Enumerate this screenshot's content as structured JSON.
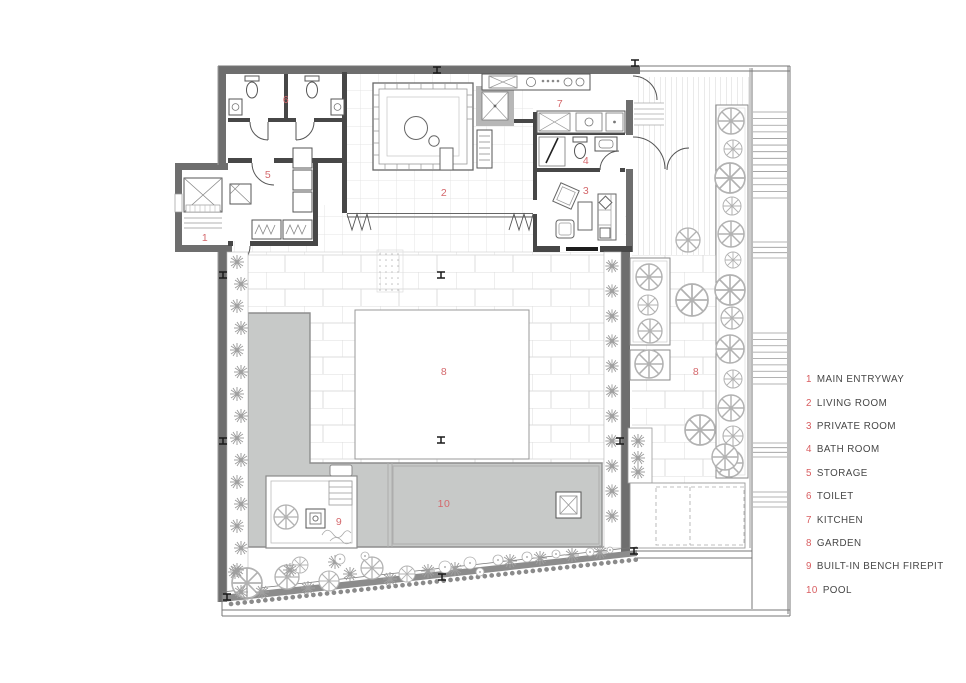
{
  "legend": {
    "items": [
      {
        "number": "1",
        "label": "MAIN ENTRYWAY"
      },
      {
        "number": "2",
        "label": "LIVING ROOM"
      },
      {
        "number": "3",
        "label": "PRIVATE ROOM"
      },
      {
        "number": "4",
        "label": "BATH ROOM"
      },
      {
        "number": "5",
        "label": "STORAGE"
      },
      {
        "number": "6",
        "label": "TOILET"
      },
      {
        "number": "7",
        "label": "KITCHEN"
      },
      {
        "number": "8",
        "label": "GARDEN"
      },
      {
        "number": "9",
        "label": "BUILT-IN BENCH FIREPIT"
      },
      {
        "number": "10",
        "label": "POOL"
      }
    ]
  },
  "plan": {
    "labels": [
      {
        "name": "main-entryway",
        "text": "1"
      },
      {
        "name": "living-room",
        "text": "2"
      },
      {
        "name": "private-room",
        "text": "3"
      },
      {
        "name": "bath-room",
        "text": "4"
      },
      {
        "name": "storage",
        "text": "5"
      },
      {
        "name": "toilet",
        "text": "6"
      },
      {
        "name": "kitchen",
        "text": "7"
      },
      {
        "name": "garden-court",
        "text": "8"
      },
      {
        "name": "garden-east",
        "text": "8"
      },
      {
        "name": "firepit",
        "text": "9"
      },
      {
        "name": "pool",
        "text": "10"
      }
    ]
  },
  "colors": {
    "room_label_red": "#d4686c",
    "legend_number_red": "#d85d60",
    "legend_text": "#474747",
    "wall_dark": "#6e6e6e",
    "wall_interior": "#474747",
    "pool_gray": "#c7c9c8"
  }
}
